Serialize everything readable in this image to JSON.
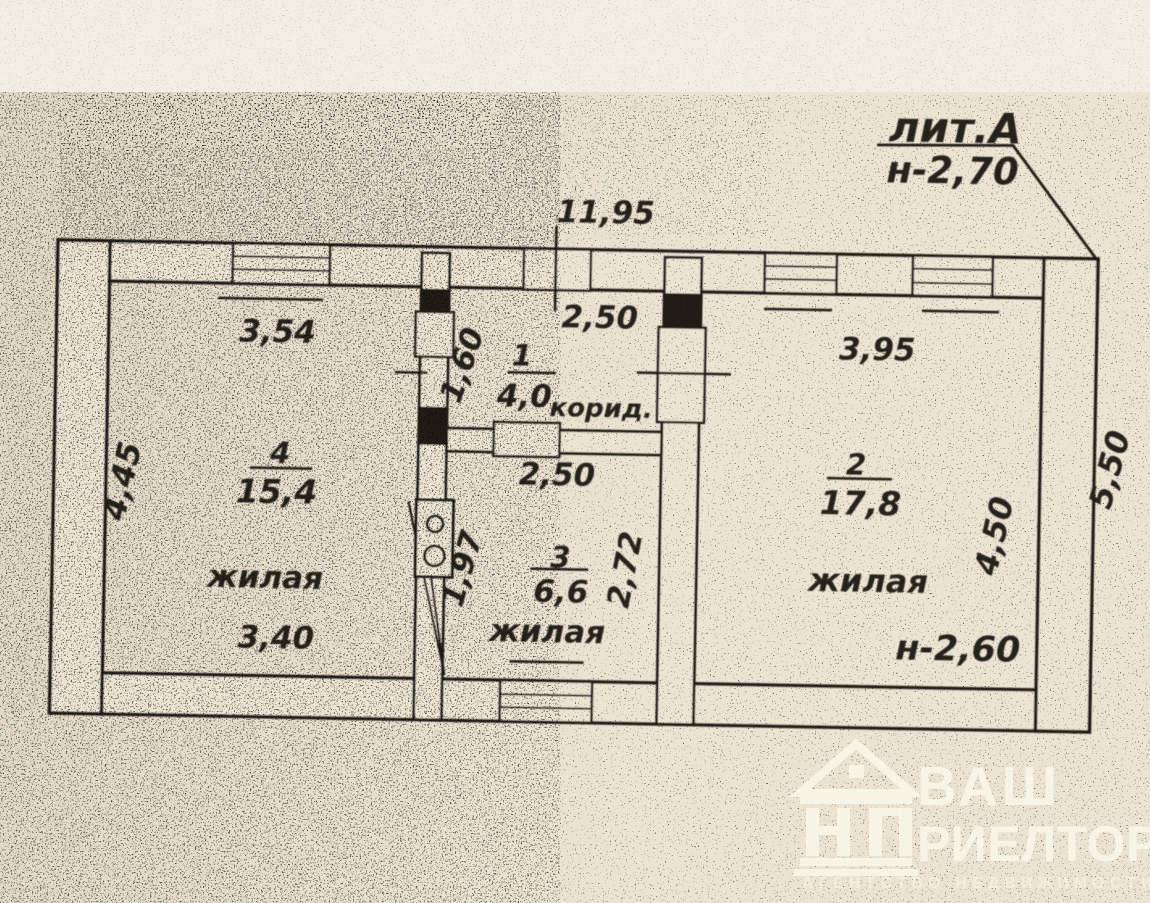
{
  "plan": {
    "building_label": "лит.А",
    "building_height": "н-2,70",
    "overall_width": "11,95",
    "overall_depth": "5,50",
    "rooms": [
      {
        "number": "1",
        "area": "4,0",
        "name": "корид.",
        "width": "2,50",
        "depth": "1,60"
      },
      {
        "number": "2",
        "area": "17,8",
        "name": "жилая",
        "width": "3,95",
        "depth": "4,50",
        "ceiling": "н-2,60"
      },
      {
        "number": "3",
        "area": "6,6",
        "name": "жилая",
        "width": "2,50",
        "depth": "2,72",
        "stove_side": "1,97"
      },
      {
        "number": "4",
        "area": "15,4",
        "name": "жилая",
        "width_top": "3,54",
        "width_bottom": "3,40",
        "depth": "4,45"
      }
    ]
  },
  "watermark": {
    "brand_top": "ВАШ",
    "brand_bottom": "РИЕЛТОР",
    "tagline": "АГЕНТСТВО НЕДВИЖИМОСТИ"
  },
  "colors": {
    "paper": "#ece4d3",
    "ink": "#211d16",
    "watermark_white": "#faf6e9"
  }
}
